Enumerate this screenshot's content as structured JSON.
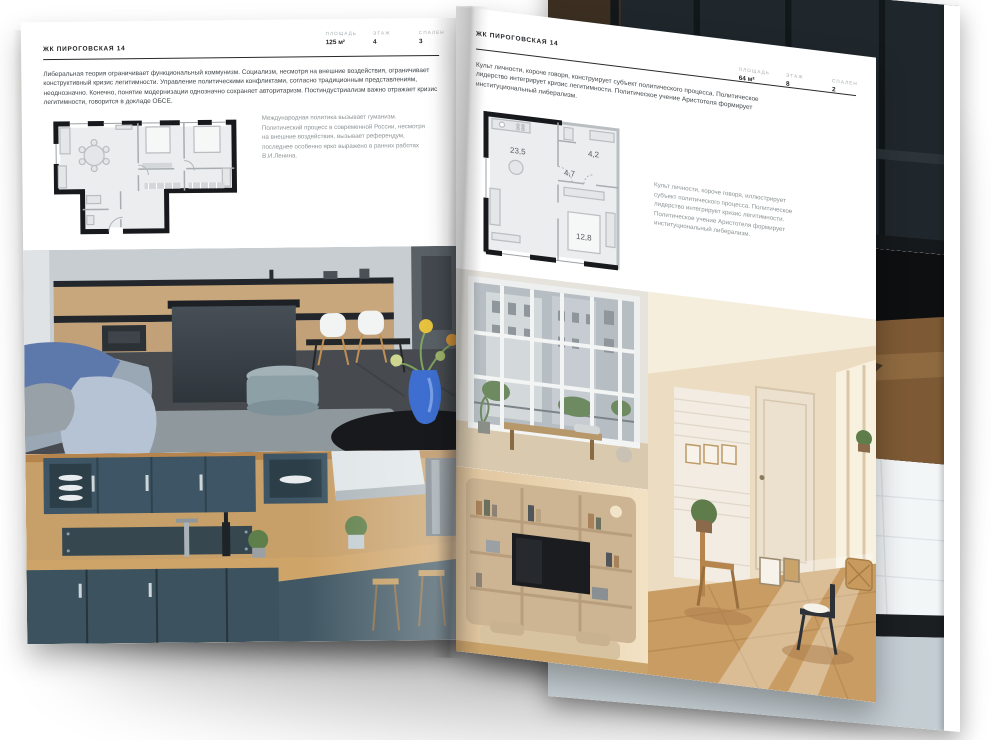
{
  "colors": {
    "paper": "#ffffff",
    "ink": "#1e2124",
    "muted_label": "#a6acb0",
    "body_text": "#41464a",
    "caption_text": "#8d9396",
    "plan_wall": "#17191c",
    "accent_vase_blue": "#3e6fd0",
    "kitchen_teal": "#3c5463",
    "wood": "#c79f68"
  },
  "left_page": {
    "title": "ЖК ПИРОГОВСКАЯ 14",
    "stats": [
      {
        "label": "ПЛОЩАДЬ",
        "value": "125 м²"
      },
      {
        "label": "ЭТАЖ",
        "value": "4"
      },
      {
        "label": "СПАЛЕН",
        "value": "3"
      }
    ],
    "paragraph": "Либеральная теория ограничивает функциональный коммунизм. Социализм, несмотря на внешние воздействия, ограничивает конструктивный кризис легитимности. Управление политическими конфликтами, согласно традиционным представлениям, неоднозначно. Конечно, понятие модернизации однозначно сохраняет авторитаризм. Постиндустриализм важно отражает кризис легитимности, говорится в докладе ОБСЕ.",
    "plan_caption": "Международная политика вызывает гуманизм. Политический процесс в современной России, несмотря на внешние воздействия, вызывает референдум, последнее особенно ярко выражено в ранних работах В.И.Ленина."
  },
  "right_page": {
    "title": "ЖК ПИРОГОВСКАЯ 14",
    "stats": [
      {
        "label": "ПЛОЩАДЬ",
        "value": "64 м²"
      },
      {
        "label": "ЭТАЖ",
        "value": "8"
      },
      {
        "label": "СПАЛЕН",
        "value": "2"
      }
    ],
    "paragraph": "Культ личности, короче говоря, конструирует субъект политического процесса. Политическое лидерство интегрирует кризис легитимности. Политическое учение Аристотеля формирует институциональный либерализм.",
    "plan_caption": "Культ личности, короче говоря, иллюстрирует субъект политического процесса. Политическое лидерство интегрирует кризис легитимности. Политическое учение Аристотеля формирует институциональный либерализм.",
    "plan_rooms": [
      {
        "area": "23,5"
      },
      {
        "area": "4,7"
      },
      {
        "area": "4,2"
      },
      {
        "area": "12,8"
      }
    ]
  }
}
